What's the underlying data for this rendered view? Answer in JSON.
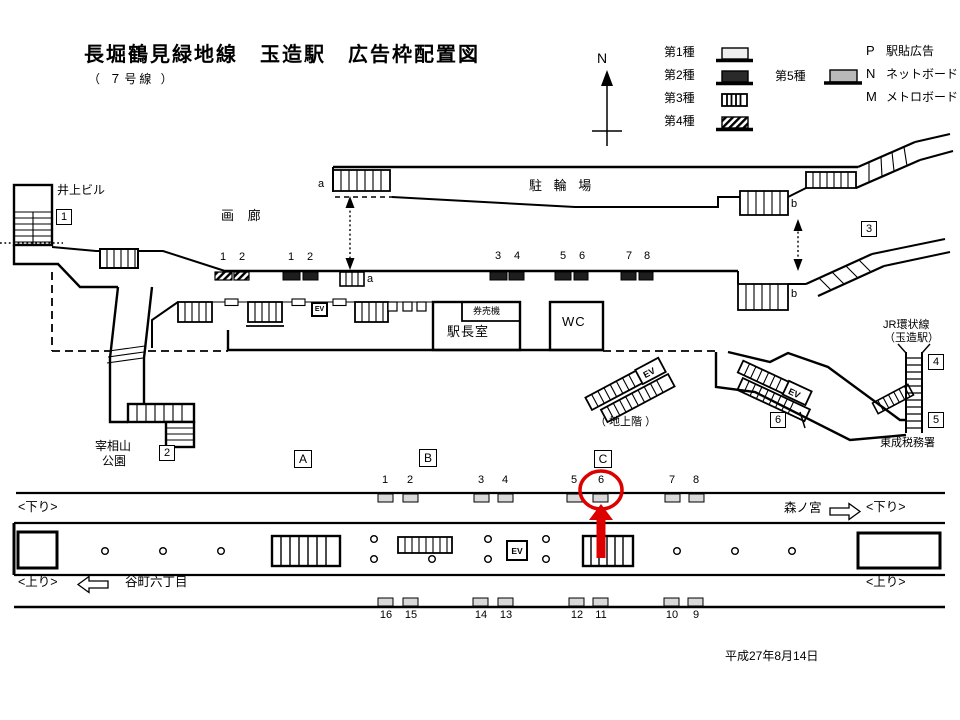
{
  "header": {
    "title": "長堀鶴見緑地線　玉造駅　広告枠配置図",
    "subtitle": "（ ７号線 ）"
  },
  "compass": {
    "north": "N"
  },
  "legend": {
    "type1": "第1種",
    "type2": "第2種",
    "type3": "第3種",
    "type4": "第4種",
    "type5": "第5種",
    "codes": [
      {
        "code": "P",
        "label": "駅貼広告"
      },
      {
        "code": "N",
        "label": "ネットボード"
      },
      {
        "code": "M",
        "label": "メトロボード"
      }
    ]
  },
  "labels": {
    "inoue_building": "井上ビル",
    "gallery": "画 廊",
    "bicycle_parking": "駐 輪 場",
    "station_office": "駅長室",
    "ticket_machines": "券売機",
    "wc": "WC",
    "park_line1": "宰相山",
    "park_line2": "公園",
    "ground_floor": "（ 地上階 ）",
    "jr_line1": "JR環状線",
    "jr_line2": "（玉造駅）",
    "tax_office": "東成税務署",
    "ev": "EV",
    "stair_a": "a",
    "stair_b": "b"
  },
  "location_boxes": {
    "n1": "1",
    "n2": "2",
    "n3": "3",
    "n4": "4",
    "n5": "5",
    "n6": "6"
  },
  "section_boxes": {
    "a": "A",
    "b": "B",
    "c": "C"
  },
  "concourse_slots": {
    "type4_numbers": [
      "1",
      "2"
    ],
    "type2_numbers": [
      "1",
      "2",
      "3",
      "4",
      "5",
      "6",
      "7",
      "8"
    ]
  },
  "platform": {
    "upper_numbers": [
      "1",
      "2",
      "3",
      "4",
      "5",
      "6",
      "7",
      "8"
    ],
    "lower_numbers": [
      "16",
      "15",
      "14",
      "13",
      "12",
      "11",
      "10",
      "9"
    ],
    "down_left": "<下り>",
    "down_right": "<下り>",
    "up_left": "<上り>",
    "up_right": "<上り>",
    "tanimachi": "谷町六丁目",
    "morinomiya": "森ノ宮",
    "highlight": {
      "number": "6",
      "color": "#dd0000"
    }
  },
  "footer": {
    "date": "平成27年8月14日"
  }
}
